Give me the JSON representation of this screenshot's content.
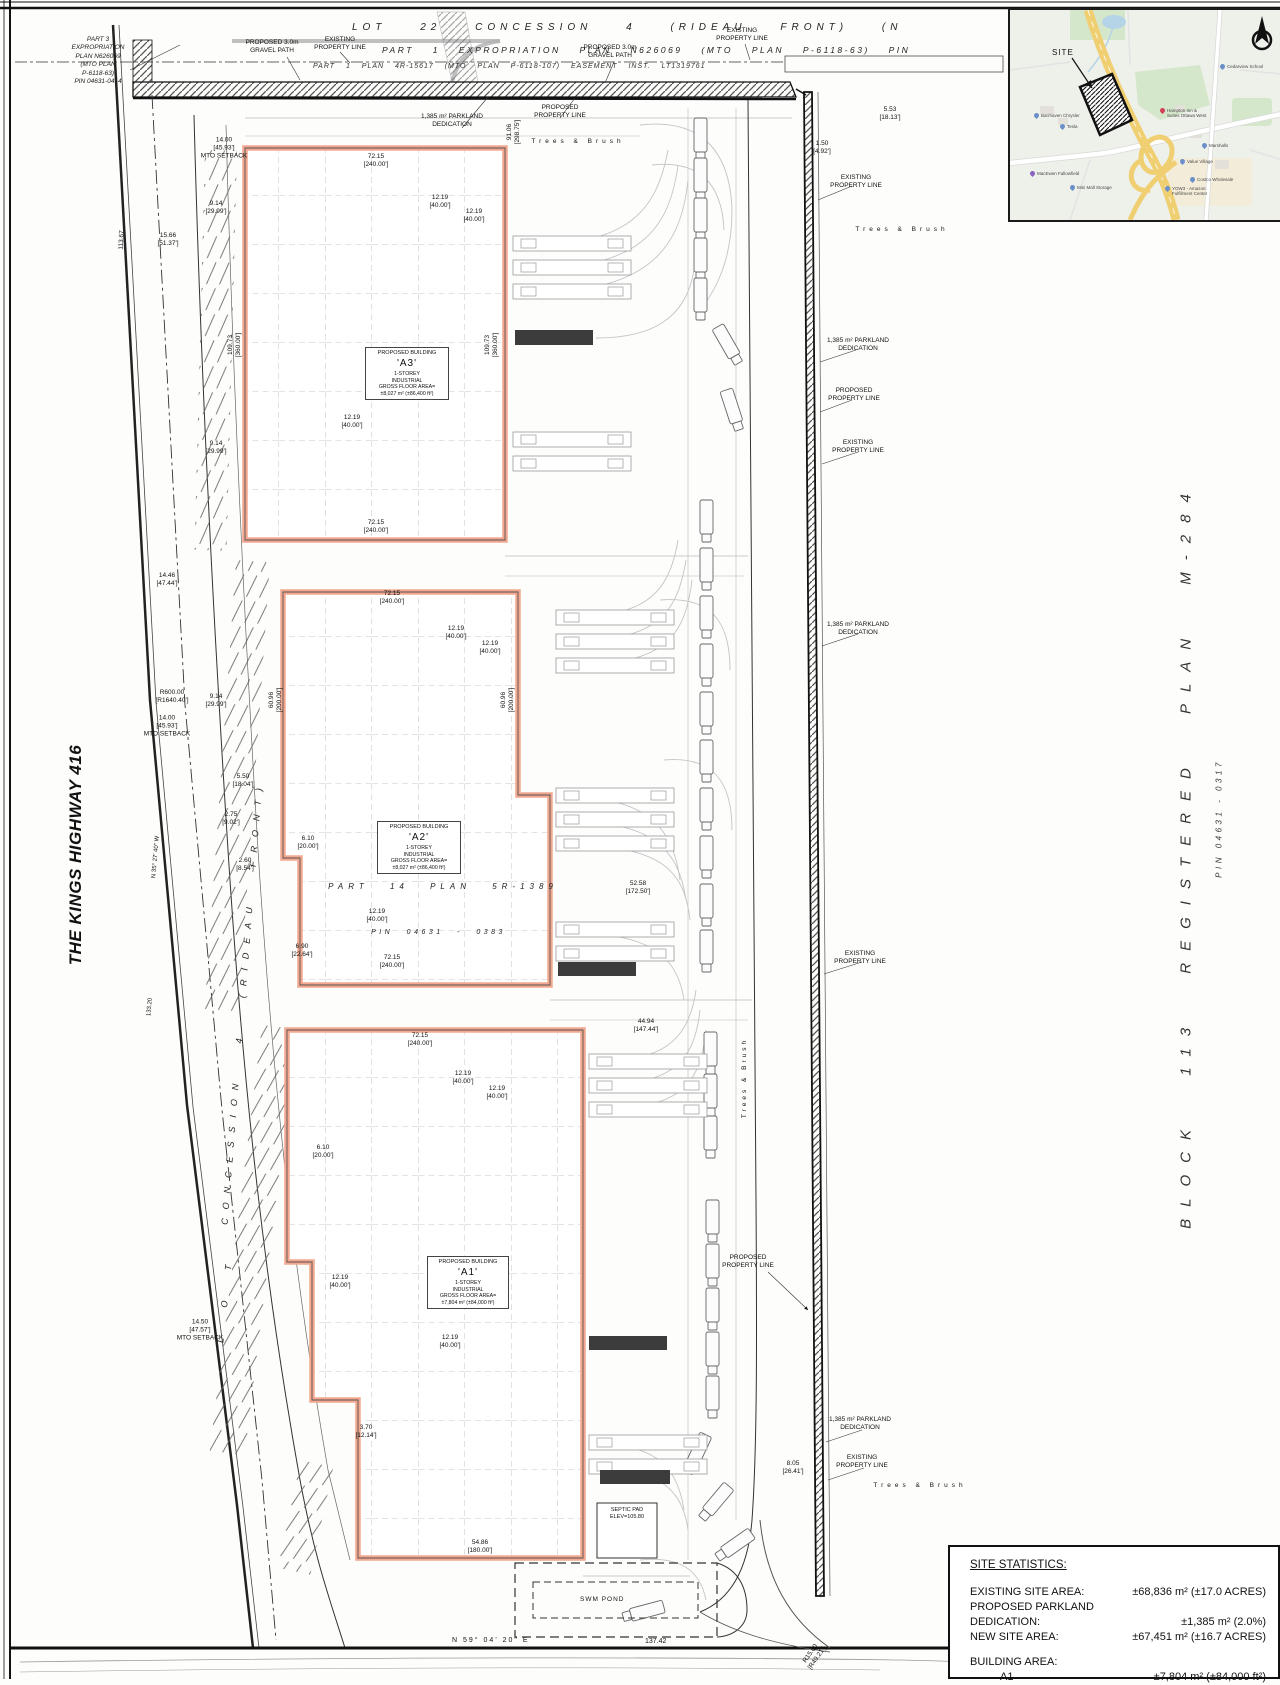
{
  "sheet": {
    "top_title_line1": "LOT 22 CONCESSION 4 (RIDEAU FRONT) (N",
    "top_title_line2": "PART 1 EXPROPRIATION PLAN N626069 (MTO PLAN P-6118-63) PIN",
    "top_title_line3": "PART 1 PLAN 4R-15617 (MTO PLAN P-6118-107) EASEMENT INST. LT1319761",
    "part3_block": "PART 3\nEXPROPRIATION\nPLAN N626069\n(MTO PLAN\nP-6118-63)\nPIN 04631-0414",
    "kings_highway": "THE KINGS HIGHWAY 416",
    "block_plan": "BLOCK 113 REGISTERED PLAN M-284",
    "pin_right": "PIN 04631 - 0317",
    "road_name": "CONCESSION 4 (RIDEAU FRONT)",
    "lot_label": "L O T",
    "part14": "PART 14 PLAN 5R-1389",
    "pin_0383": "PIN 04631 - 0383",
    "bearing_bottom": "N 59° 04' 20\" E",
    "dist_bottom": "137.42",
    "bearing_left": "N 35° 27' 40\" W",
    "dist_left": "133.20"
  },
  "buildings": [
    {
      "id": "A3",
      "title": "PROPOSED BUILDING",
      "name": "'A3'",
      "l1": "1-STOREY",
      "l2": "INDUSTRIAL",
      "l3": "GROSS FLOOR AREA=",
      "l4": "±8,027 m² (±86,400 ft²)"
    },
    {
      "id": "A2",
      "title": "PROPOSED BUILDING",
      "name": "'A2'",
      "l1": "1-STOREY",
      "l2": "INDUSTRIAL",
      "l3": "GROSS FLOOR AREA=",
      "l4": "±8,027 m² (±86,400 ft²)"
    },
    {
      "id": "A1",
      "title": "PROPOSED BUILDING",
      "name": "'A1'",
      "l1": "1-STOREY",
      "l2": "INDUSTRIAL",
      "l3": "GROSS FLOOR AREA=",
      "l4": "±7,804 m² (±84,000 ft²)"
    }
  ],
  "features": {
    "swm_pond": "SWM POND",
    "septic": "SEPTIC PAD\nELEV=105.80"
  },
  "site_statistics": {
    "title": "SITE STATISTICS:",
    "rows": [
      {
        "label": "EXISTING SITE AREA:",
        "value": "±68,836 m² (±17.0 ACRES)"
      },
      {
        "label": "PROPOSED PARKLAND DEDICATION:",
        "value": "±1,385 m² (2.0%)"
      },
      {
        "label": "NEW SITE AREA:",
        "value": "±67,451 m² (±16.7 ACRES)"
      }
    ],
    "building_area_label": "BUILDING AREA:",
    "building_rows": [
      {
        "label": "A1",
        "value": "±7,804 m² (±84,000 ft²)"
      }
    ]
  },
  "map": {
    "site_label": "SITE",
    "accent_highway_color": "#f0cf72",
    "park_color": "#d5e7cb",
    "water_color": "#b5d4e7",
    "pois": [
      {
        "n": "Cedarview School",
        "x": 210,
        "y": 54,
        "c": "#6b8fc9"
      },
      {
        "n": "Hampton Inn &\nSuites Ottawa West",
        "x": 150,
        "y": 98,
        "c": "#d23f57"
      },
      {
        "n": "Barrhaven Chrysler",
        "x": 24,
        "y": 103,
        "c": "#6b8fc9"
      },
      {
        "n": "Tesla",
        "x": 50,
        "y": 114,
        "c": "#6b8fc9"
      },
      {
        "n": "Marshalls",
        "x": 192,
        "y": 133,
        "c": "#6b8fc9"
      },
      {
        "n": "Value Village",
        "x": 170,
        "y": 149,
        "c": "#6b8fc9"
      },
      {
        "n": "Costco Wholesale",
        "x": 180,
        "y": 167,
        "c": "#6b8fc9"
      },
      {
        "n": "MacEwen Fallowfield",
        "x": 20,
        "y": 161,
        "c": "#8b64c0"
      },
      {
        "n": "Mini Mall Storage",
        "x": 60,
        "y": 175,
        "c": "#6b8fc9"
      },
      {
        "n": "YOW3 - Amazon\nFulfillment Center",
        "x": 155,
        "y": 176,
        "c": "#6b8fc9"
      }
    ]
  },
  "annotations": [
    {
      "t": "PROPOSED 3.0m\nGRAVEL PATH",
      "x": 272,
      "y": 47
    },
    {
      "t": "EXISTING\nPROPERTY LINE",
      "x": 340,
      "y": 44
    },
    {
      "t": "PROPOSED 3.0m\nGRAVEL PATH",
      "x": 610,
      "y": 52
    },
    {
      "t": "EXISTING\nPROPERTY LINE",
      "x": 742,
      "y": 35
    },
    {
      "t": "PROPOSED\nPROPERTY LINE",
      "x": 560,
      "y": 112
    },
    {
      "t": "1,385 m² PARKLAND\nDEDICATION",
      "x": 452,
      "y": 121
    },
    {
      "t": "Trees & Brush",
      "x": 578,
      "y": 142,
      "sp": 4
    },
    {
      "t": "Trees & Brush",
      "x": 902,
      "y": 230,
      "sp": 4
    },
    {
      "t": "Trees & Brush",
      "x": 920,
      "y": 1486,
      "sp": 4
    },
    {
      "t": "Trees & Brush",
      "x": 745,
      "y": 1078,
      "r": -90,
      "sp": 3
    },
    {
      "t": "5.53\n[18.13']",
      "x": 890,
      "y": 114
    },
    {
      "t": "1.50\n[4.92']",
      "x": 822,
      "y": 148
    },
    {
      "t": "EXISTING\nPROPERTY LINE",
      "x": 856,
      "y": 182
    },
    {
      "t": "1,385 m² PARKLAND\nDEDICATION",
      "x": 858,
      "y": 345
    },
    {
      "t": "PROPOSED\nPROPERTY LINE",
      "x": 854,
      "y": 395
    },
    {
      "t": "EXISTING\nPROPERTY LINE",
      "x": 858,
      "y": 447
    },
    {
      "t": "1,385 m² PARKLAND\nDEDICATION",
      "x": 858,
      "y": 629
    },
    {
      "t": "EXISTING\nPROPERTY LINE",
      "x": 860,
      "y": 958
    },
    {
      "t": "PROPOSED\nPROPERTY LINE",
      "x": 748,
      "y": 1262
    },
    {
      "t": "1,385 m² PARKLAND\nDEDICATION",
      "x": 860,
      "y": 1424
    },
    {
      "t": "EXISTING\nPROPERTY LINE",
      "x": 862,
      "y": 1462
    },
    {
      "t": "14.00\n[45.93']\nMTO SETBACK",
      "x": 224,
      "y": 148
    },
    {
      "t": "15.66\n[51.37']",
      "x": 168,
      "y": 240
    },
    {
      "t": "9.14\n[29.99']",
      "x": 216,
      "y": 208
    },
    {
      "t": "113.67",
      "x": 122,
      "y": 240,
      "r": -87
    },
    {
      "t": "72.15\n[240.00']",
      "x": 376,
      "y": 161
    },
    {
      "t": "12.19\n[40.00']",
      "x": 440,
      "y": 202
    },
    {
      "t": "12.19\n[40.00']",
      "x": 474,
      "y": 216
    },
    {
      "t": "109.73\n[360.00']",
      "x": 235,
      "y": 345,
      "r": -90
    },
    {
      "t": "109.73\n[360.00']",
      "x": 492,
      "y": 345,
      "r": -90
    },
    {
      "t": "12.19\n[40.00']",
      "x": 352,
      "y": 422
    },
    {
      "t": "9.14\n[29.99']",
      "x": 216,
      "y": 448
    },
    {
      "t": "72.15\n[240.00']",
      "x": 376,
      "y": 527
    },
    {
      "t": "91.06\n[298.75']",
      "x": 514,
      "y": 132,
      "r": -90
    },
    {
      "t": "14.46\n[47.44']",
      "x": 167,
      "y": 580
    },
    {
      "t": "R600.00\n[R1640.40']",
      "x": 172,
      "y": 697
    },
    {
      "t": "9.14\n[29.99']",
      "x": 216,
      "y": 701
    },
    {
      "t": "14.00\n[45.93']\nMTO SETBACK",
      "x": 167,
      "y": 726
    },
    {
      "t": "5.50\n[18.04']",
      "x": 243,
      "y": 781
    },
    {
      "t": "2.75\n[9.02']",
      "x": 231,
      "y": 819
    },
    {
      "t": "2.60\n[8.54']",
      "x": 245,
      "y": 865
    },
    {
      "t": "14.50\n[47.57']\nMTO SETBACK",
      "x": 200,
      "y": 1330
    },
    {
      "t": "72.15\n[240.00']",
      "x": 392,
      "y": 598
    },
    {
      "t": "12.19\n[40.00']",
      "x": 456,
      "y": 633
    },
    {
      "t": "12.19\n[40.00']",
      "x": 490,
      "y": 648
    },
    {
      "t": "60.96\n[200.00']",
      "x": 276,
      "y": 700,
      "r": -90
    },
    {
      "t": "60.96\n[200.00']",
      "x": 508,
      "y": 700,
      "r": -90
    },
    {
      "t": "6.10\n[20.00']",
      "x": 308,
      "y": 843
    },
    {
      "t": "12.19\n[40.00']",
      "x": 377,
      "y": 916
    },
    {
      "t": "6.90\n[22.64']",
      "x": 302,
      "y": 951
    },
    {
      "t": "72.15\n[240.00']",
      "x": 392,
      "y": 962
    },
    {
      "t": "52.58\n[172.50']",
      "x": 638,
      "y": 888
    },
    {
      "t": "44.94\n[147.44']",
      "x": 646,
      "y": 1026
    },
    {
      "t": "72.15\n[240.00']",
      "x": 420,
      "y": 1040
    },
    {
      "t": "12.19\n[40.00']",
      "x": 463,
      "y": 1078
    },
    {
      "t": "12.19\n[40.00']",
      "x": 497,
      "y": 1093
    },
    {
      "t": "6.10\n[20.00']",
      "x": 323,
      "y": 1152
    },
    {
      "t": "12.19\n[40.00']",
      "x": 340,
      "y": 1282
    },
    {
      "t": "12.19\n[40.00']",
      "x": 450,
      "y": 1342
    },
    {
      "t": "3.70\n[12.14']",
      "x": 366,
      "y": 1432
    },
    {
      "t": "54.86\n[180.00']",
      "x": 480,
      "y": 1547
    },
    {
      "t": "8.05\n[26.41']",
      "x": 793,
      "y": 1468
    },
    {
      "t": "R15.00\n[R49.21']",
      "x": 814,
      "y": 1656,
      "r": -55
    }
  ]
}
